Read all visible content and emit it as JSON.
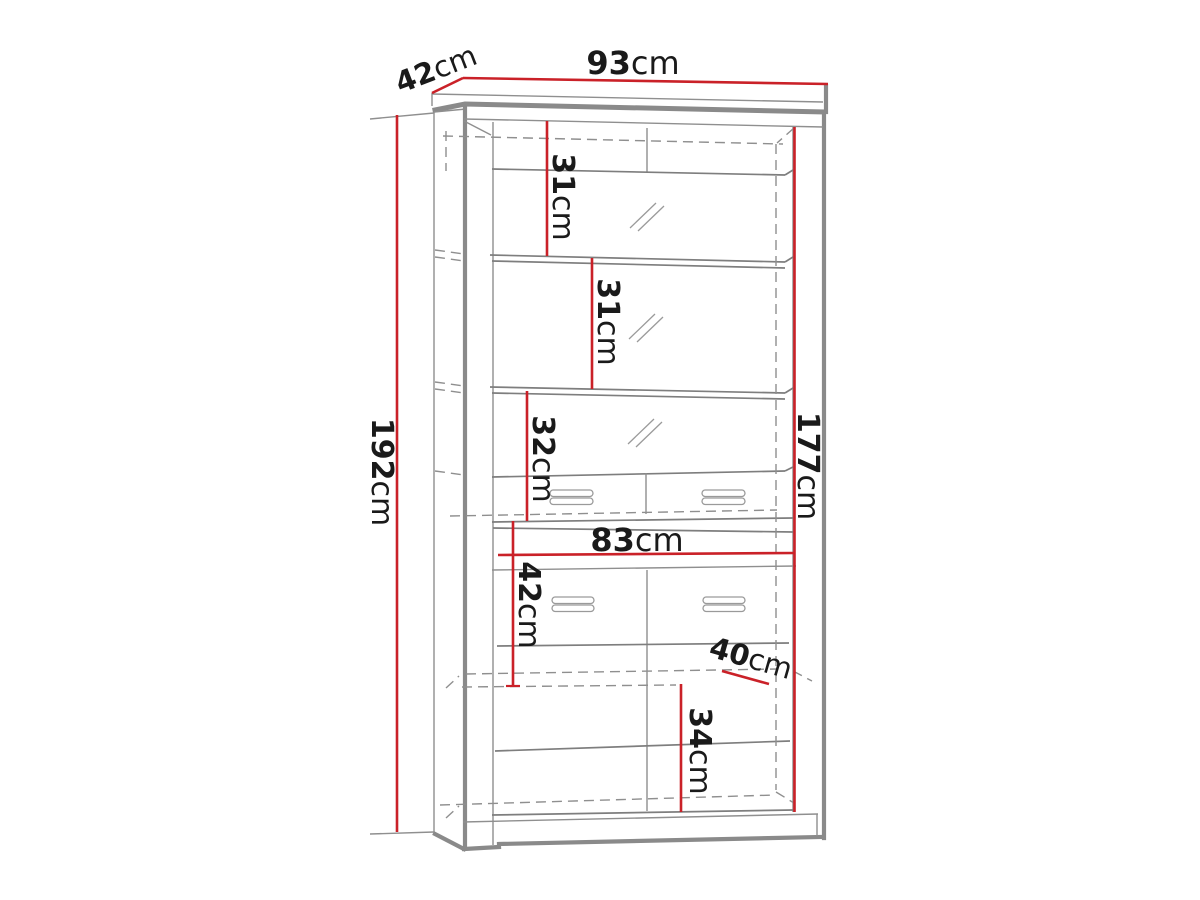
{
  "diagram": {
    "type": "furniture-dimension-drawing",
    "subject": "display cabinet with glass doors, drawers and lower doors",
    "background_color": "#ffffff",
    "accent_color": "#ca2128",
    "line_color": "#8f8f8f",
    "text_color": "#1a1a1a",
    "dimensions": {
      "overall_width": {
        "value": "93",
        "unit": "cm"
      },
      "top_depth": {
        "value": "42",
        "unit": "cm"
      },
      "overall_height": {
        "value": "192",
        "unit": "cm"
      },
      "interior_height": {
        "value": "177",
        "unit": "cm"
      },
      "shelf_section_1": {
        "value": "31",
        "unit": "cm"
      },
      "shelf_section_2": {
        "value": "31",
        "unit": "cm"
      },
      "shelf_section_3": {
        "value": "32",
        "unit": "cm"
      },
      "lower_width": {
        "value": "83",
        "unit": "cm"
      },
      "lower_drawer_height": {
        "value": "42",
        "unit": "cm"
      },
      "lower_depth": {
        "value": "40",
        "unit": "cm"
      },
      "lower_door_height": {
        "value": "34",
        "unit": "cm"
      }
    }
  }
}
